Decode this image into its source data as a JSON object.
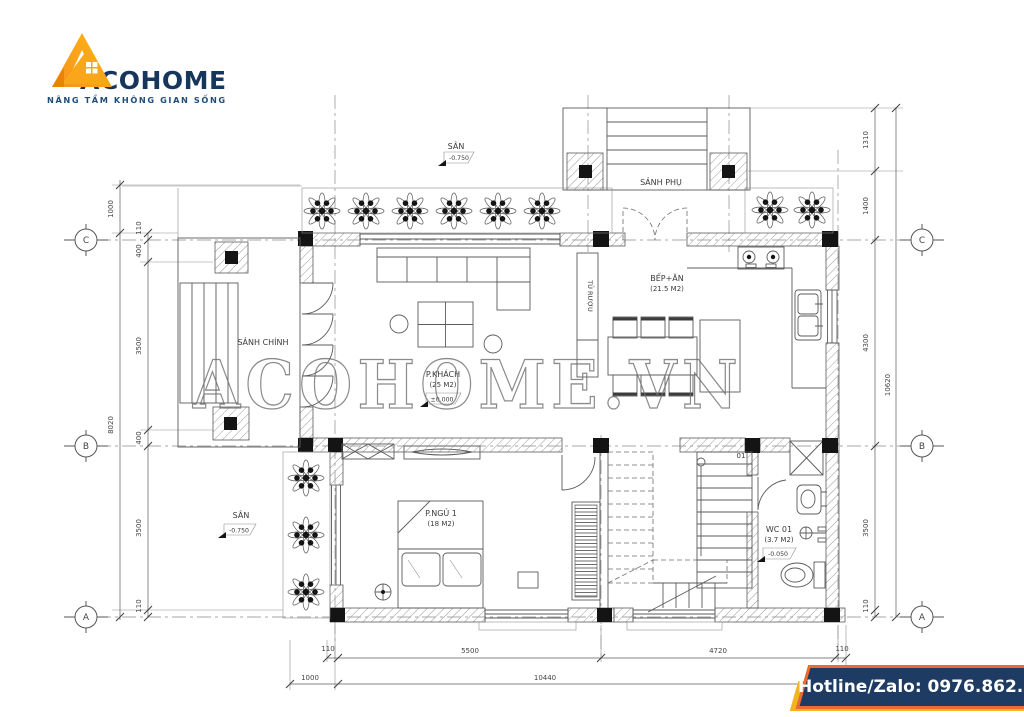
{
  "logo": {
    "brand": "ACOHOME",
    "tagline": "NÂNG TẦM KHÔNG GIAN SỐNG",
    "colors": {
      "orange": "#F6921E",
      "yellow": "#FDB515",
      "navy": "#16365C"
    }
  },
  "watermark": "ACOHOME.VN",
  "hotline": {
    "label": "Hotline/Zalo: 0976.862.595",
    "bg": "#1d3b63",
    "border": "#ee6a31",
    "shadow": "#f2b51d"
  },
  "plan": {
    "grid": [
      "C",
      "B",
      "A"
    ],
    "stair_label": "01",
    "rooms": {
      "san_top": {
        "name": "SÂN",
        "level": "-0.750"
      },
      "sanh_phu": {
        "name": "SẢNH PHỤ"
      },
      "sanh_chinh": {
        "name": "SẢNH CHÍNH"
      },
      "p_khach": {
        "name": "P.KHÁCH",
        "area": "(25 M2)",
        "level": "±0.000"
      },
      "tu_ruou": {
        "name": "TỦ RƯỢU"
      },
      "bep_an": {
        "name": "BẾP+ĂN",
        "area": "(21.5 M2)"
      },
      "p_ngu1": {
        "name": "P.NGỦ 1",
        "area": "(18 M2)"
      },
      "wc01": {
        "name": "WC 01",
        "area": "(3.7 M2)",
        "level": "-0.050"
      },
      "san_left": {
        "name": "SÂN",
        "level": "-0.750"
      }
    },
    "dims": {
      "left": [
        "1000",
        "110",
        "400",
        "3500",
        "400",
        "3500",
        "110",
        "8020"
      ],
      "right": [
        "1310",
        "1400",
        "4300",
        "3500",
        "110",
        "10620"
      ],
      "bottom": [
        "110",
        "5500",
        "4720",
        "110",
        "1000",
        "10440"
      ]
    }
  }
}
